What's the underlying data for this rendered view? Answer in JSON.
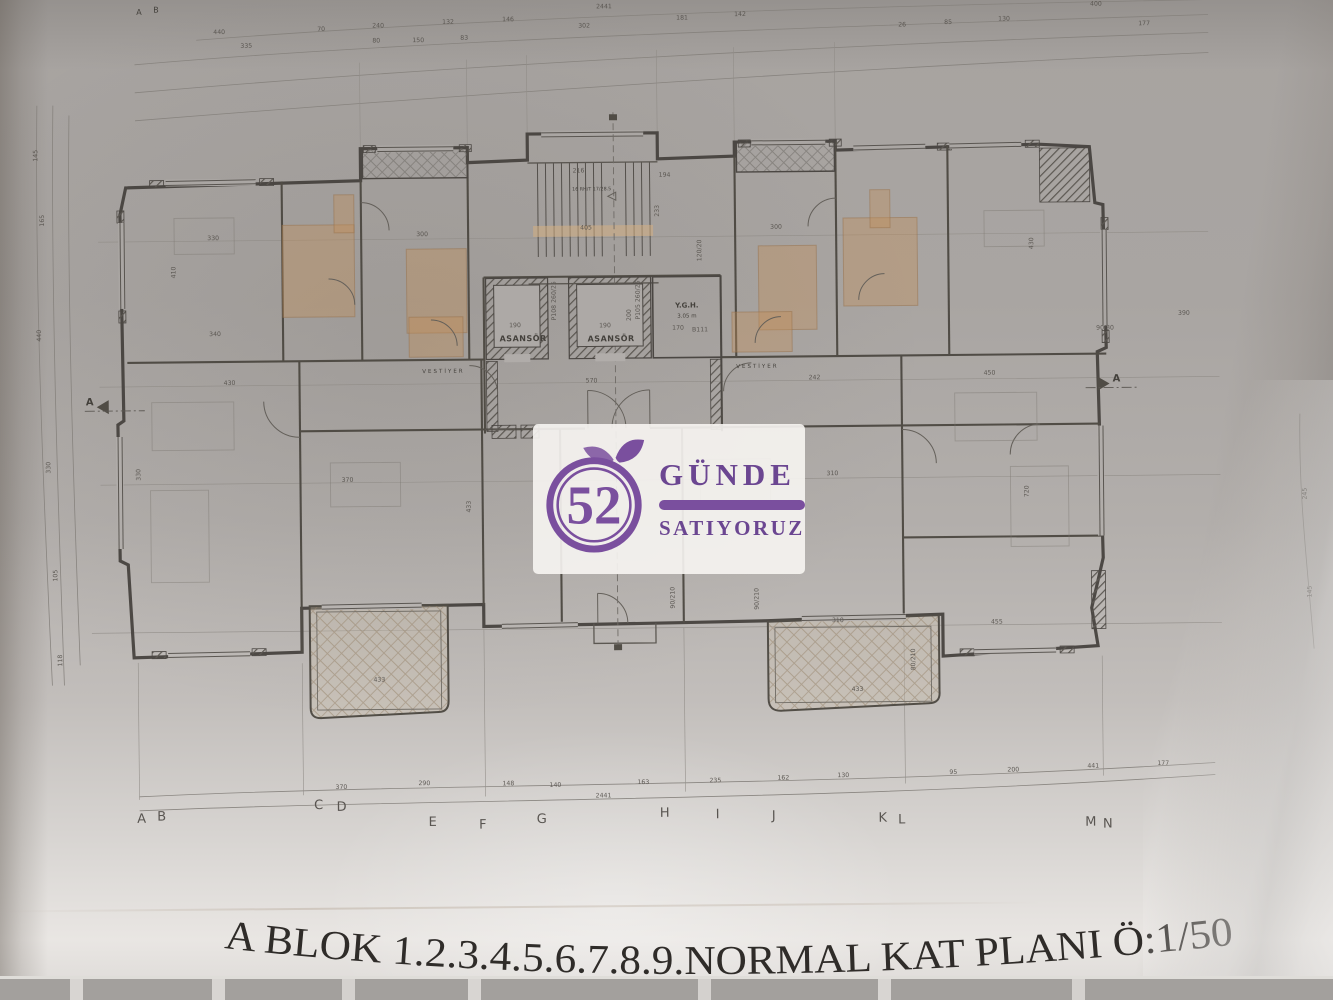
{
  "colors": {
    "logo-purple": "#7a4f9e",
    "text-purple": "#6b4691",
    "paper": "#b2aeab",
    "ink": "#45413d",
    "tint-orange": "#c68d54"
  },
  "title": {
    "text": "A BLOK 1.2.3.4.5.6.7.8.9.NORMAL KAT PLANI Ö:1/50"
  },
  "watermark": {
    "number": "52",
    "word1": "GÜNDE",
    "word2": "SATIYORUZ"
  },
  "plan": {
    "room_labels": [
      {
        "t": "ASANSÖR",
        "x": 524,
        "y": 340,
        "s": 8,
        "b": true,
        "ls": 0.5
      },
      {
        "t": "ASANSÖR",
        "x": 612,
        "y": 341,
        "s": 8,
        "b": true,
        "ls": 0.5
      },
      {
        "t": "Y.G.H.",
        "x": 688,
        "y": 308,
        "s": 7,
        "b": true
      },
      {
        "t": "3.05 m",
        "x": 688,
        "y": 318,
        "s": 5.5
      },
      {
        "t": "VESTİYER",
        "x": 444,
        "y": 371,
        "s": 5.5,
        "ls": 2
      },
      {
        "t": "VESTİYER",
        "x": 758,
        "y": 369,
        "s": 5.5,
        "ls": 2
      },
      {
        "t": "16 RH/T 17/28.5",
        "x": 594,
        "y": 190,
        "s": 4.8
      },
      {
        "t": "A",
        "x": 90,
        "y": 400,
        "s": 10,
        "b": true
      },
      {
        "t": "A",
        "x": 1117,
        "y": 386,
        "s": 10,
        "b": true
      },
      {
        "t": "A",
        "x": 143,
        "y": 10,
        "s": 8
      },
      {
        "t": "B",
        "x": 160,
        "y": 8,
        "s": 8
      }
    ],
    "axis_letters": [
      {
        "t": "A",
        "x": 138,
        "y": 818
      },
      {
        "t": "B",
        "x": 158,
        "y": 816
      },
      {
        "t": "C",
        "x": 315,
        "y": 806
      },
      {
        "t": "D",
        "x": 338,
        "y": 808
      },
      {
        "t": "E",
        "x": 429,
        "y": 824
      },
      {
        "t": "F",
        "x": 479,
        "y": 827
      },
      {
        "t": "G",
        "x": 538,
        "y": 822
      },
      {
        "t": "H",
        "x": 661,
        "y": 817
      },
      {
        "t": "I",
        "x": 714,
        "y": 819
      },
      {
        "t": "J",
        "x": 770,
        "y": 821
      },
      {
        "t": "K",
        "x": 879,
        "y": 824
      },
      {
        "t": "L",
        "x": 898,
        "y": 826
      },
      {
        "t": "M",
        "x": 1087,
        "y": 830
      },
      {
        "t": "N",
        "x": 1104,
        "y": 832
      }
    ],
    "dim_numbers": [
      {
        "t": "2441",
        "x": 608,
        "y": 8,
        "s": 6
      },
      {
        "t": "302",
        "x": 588,
        "y": 27
      },
      {
        "t": "181",
        "x": 686,
        "y": 20
      },
      {
        "t": "142",
        "x": 744,
        "y": 17
      },
      {
        "t": "440",
        "x": 223,
        "y": 30
      },
      {
        "t": "70",
        "x": 325,
        "y": 28
      },
      {
        "t": "240",
        "x": 382,
        "y": 25
      },
      {
        "t": "132",
        "x": 452,
        "y": 22
      },
      {
        "t": "146",
        "x": 512,
        "y": 20
      },
      {
        "t": "400",
        "x": 1100,
        "y": 10,
        "s": 5.5
      },
      {
        "t": "177",
        "x": 1148,
        "y": 30
      },
      {
        "t": "130",
        "x": 1008,
        "y": 24
      },
      {
        "t": "85",
        "x": 952,
        "y": 27
      },
      {
        "t": "26",
        "x": 906,
        "y": 29
      },
      {
        "t": "335",
        "x": 250,
        "y": 44
      },
      {
        "t": "80",
        "x": 380,
        "y": 40
      },
      {
        "t": "150",
        "x": 422,
        "y": 40
      },
      {
        "t": "83",
        "x": 468,
        "y": 38
      },
      {
        "t": "145",
        "x": 40,
        "y": 150,
        "r": -90
      },
      {
        "t": "165",
        "x": 46,
        "y": 215,
        "r": -90
      },
      {
        "t": "440",
        "x": 42,
        "y": 330,
        "r": -90
      },
      {
        "t": "330",
        "x": 50,
        "y": 462,
        "r": -90
      },
      {
        "t": "105",
        "x": 56,
        "y": 570,
        "r": -90
      },
      {
        "t": "118",
        "x": 60,
        "y": 655,
        "r": -90
      },
      {
        "t": "245",
        "x": 1306,
        "y": 500,
        "r": -90,
        "s": 5.5
      },
      {
        "t": "145",
        "x": 1310,
        "y": 598,
        "r": -90,
        "s": 5.5
      },
      {
        "t": "90/30",
        "x": 1106,
        "y": 334,
        "s": 4.8
      },
      {
        "t": "390",
        "x": 1185,
        "y": 320,
        "s": 5.5
      },
      {
        "t": "2441",
        "x": 600,
        "y": 797,
        "s": 6
      },
      {
        "t": "370",
        "x": 338,
        "y": 786
      },
      {
        "t": "290",
        "x": 421,
        "y": 783
      },
      {
        "t": "148",
        "x": 505,
        "y": 784
      },
      {
        "t": "140",
        "x": 552,
        "y": 786
      },
      {
        "t": "163",
        "x": 640,
        "y": 784
      },
      {
        "t": "235",
        "x": 712,
        "y": 783
      },
      {
        "t": "162",
        "x": 780,
        "y": 781
      },
      {
        "t": "130",
        "x": 840,
        "y": 779
      },
      {
        "t": "95",
        "x": 950,
        "y": 777
      },
      {
        "t": "200",
        "x": 1010,
        "y": 775
      },
      {
        "t": "441",
        "x": 1090,
        "y": 772
      },
      {
        "t": "177",
        "x": 1160,
        "y": 770
      },
      {
        "t": "330",
        "x": 215,
        "y": 236
      },
      {
        "t": "300",
        "x": 424,
        "y": 234
      },
      {
        "t": "300",
        "x": 778,
        "y": 230
      },
      {
        "t": "430",
        "x": 230,
        "y": 381
      },
      {
        "t": "242",
        "x": 815,
        "y": 381
      },
      {
        "t": "450",
        "x": 990,
        "y": 378
      },
      {
        "t": "310",
        "x": 832,
        "y": 477
      },
      {
        "t": "370",
        "x": 347,
        "y": 479
      },
      {
        "t": "570",
        "x": 592,
        "y": 382,
        "s": 5.5
      },
      {
        "t": "216",
        "x": 581,
        "y": 172
      },
      {
        "t": "194",
        "x": 667,
        "y": 177
      },
      {
        "t": "405",
        "x": 588,
        "y": 229
      },
      {
        "t": "233",
        "x": 661,
        "y": 211,
        "r": -90,
        "s": 5.5
      },
      {
        "t": "120/20",
        "x": 703,
        "y": 251,
        "r": -90,
        "s": 4.8
      },
      {
        "t": "190",
        "x": 516,
        "y": 326,
        "s": 5.5
      },
      {
        "t": "190",
        "x": 606,
        "y": 327,
        "s": 5.5
      },
      {
        "t": "200",
        "x": 632,
        "y": 315,
        "r": -90,
        "s": 5.5
      },
      {
        "t": "170",
        "x": 679,
        "y": 330,
        "s": 5
      },
      {
        "t": "B111",
        "x": 701,
        "y": 332,
        "s": 5
      },
      {
        "t": "P108 260/25",
        "x": 557,
        "y": 300,
        "r": -90,
        "s": 4.5
      },
      {
        "t": "P105 260/25",
        "x": 641,
        "y": 300,
        "r": -90,
        "s": 4.5
      },
      {
        "t": "310",
        "x": 836,
        "y": 624
      },
      {
        "t": "433",
        "x": 855,
        "y": 693
      },
      {
        "t": "433",
        "x": 377,
        "y": 679
      },
      {
        "t": "455",
        "x": 995,
        "y": 627
      },
      {
        "t": "340",
        "x": 216,
        "y": 332
      },
      {
        "t": "410",
        "x": 177,
        "y": 268,
        "r": -90
      },
      {
        "t": "433",
        "x": 470,
        "y": 505,
        "r": -90
      },
      {
        "t": "720",
        "x": 1028,
        "y": 495,
        "r": -90,
        "s": 5.5
      },
      {
        "t": "80/210",
        "x": 913,
        "y": 662,
        "r": -90,
        "s": 4.8
      },
      {
        "t": "90/210",
        "x": 673,
        "y": 598,
        "r": -90,
        "s": 4.8
      },
      {
        "t": "90/210",
        "x": 757,
        "y": 600,
        "r": -90,
        "s": 4.8
      },
      {
        "t": "330",
        "x": 140,
        "y": 470,
        "r": -90
      },
      {
        "t": "430",
        "x": 1035,
        "y": 247,
        "r": -90
      }
    ]
  }
}
